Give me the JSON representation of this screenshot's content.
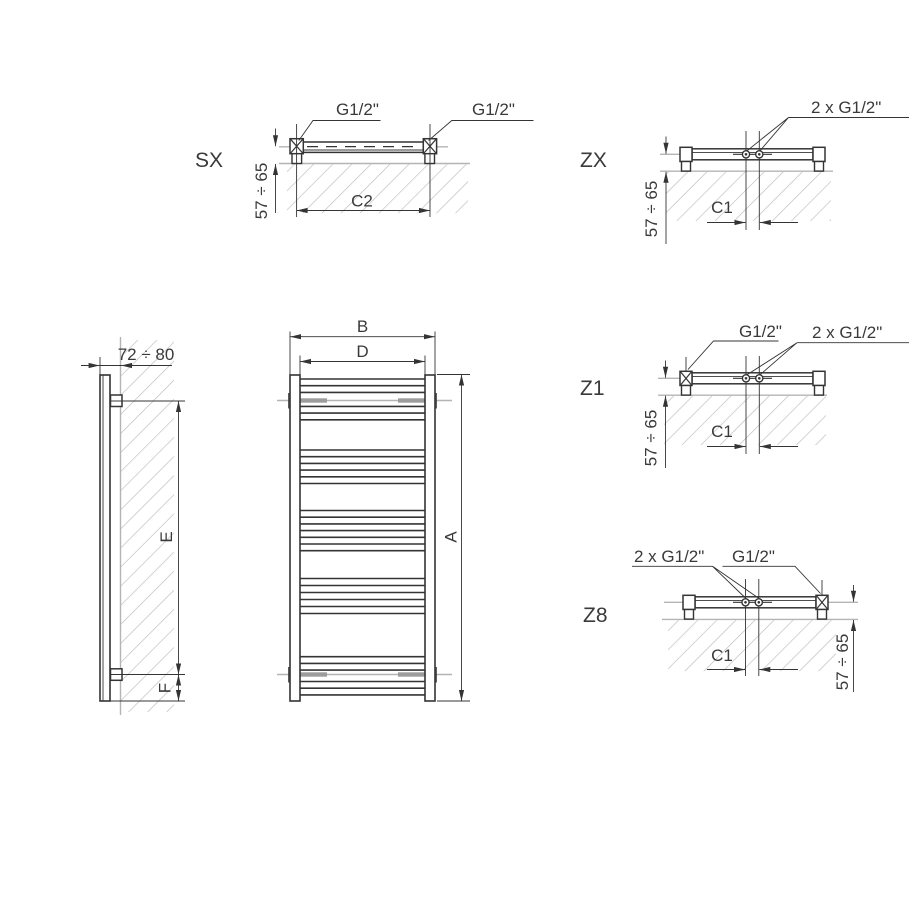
{
  "drawing": {
    "connection_types": {
      "sx": {
        "label": "SX",
        "port_left": "G1/2\"",
        "port_right": "G1/2\"",
        "wall_distance": "57 ÷ 65",
        "connection_span": "C2"
      },
      "zx": {
        "label": "ZX",
        "center_ports": "2 x G1/2\"",
        "wall_distance": "57 ÷ 65",
        "center_spacing": "C1"
      },
      "z1": {
        "label": "Z1",
        "side_port": "G1/2\"",
        "center_ports": "2 x G1/2\"",
        "wall_distance": "57 ÷ 65",
        "center_spacing": "C1"
      },
      "z8": {
        "label": "Z8",
        "center_ports": "2 x G1/2\"",
        "side_port": "G1/2\"",
        "wall_distance": "57 ÷ 65",
        "center_spacing": "C1"
      }
    },
    "side_view": {
      "depth_to_wall": "72 ÷ 80",
      "bracket_spacing": "E",
      "bottom_bracket_offset": "F"
    },
    "front_view": {
      "overall_height": "A",
      "overall_width": "B",
      "inner_width": "D"
    }
  },
  "colors": {
    "line": "#343434",
    "light_gray": "#b4b4b4",
    "bracket_tab": "#9c9c9c",
    "text": "#3a3a3a",
    "background": "#ffffff"
  }
}
